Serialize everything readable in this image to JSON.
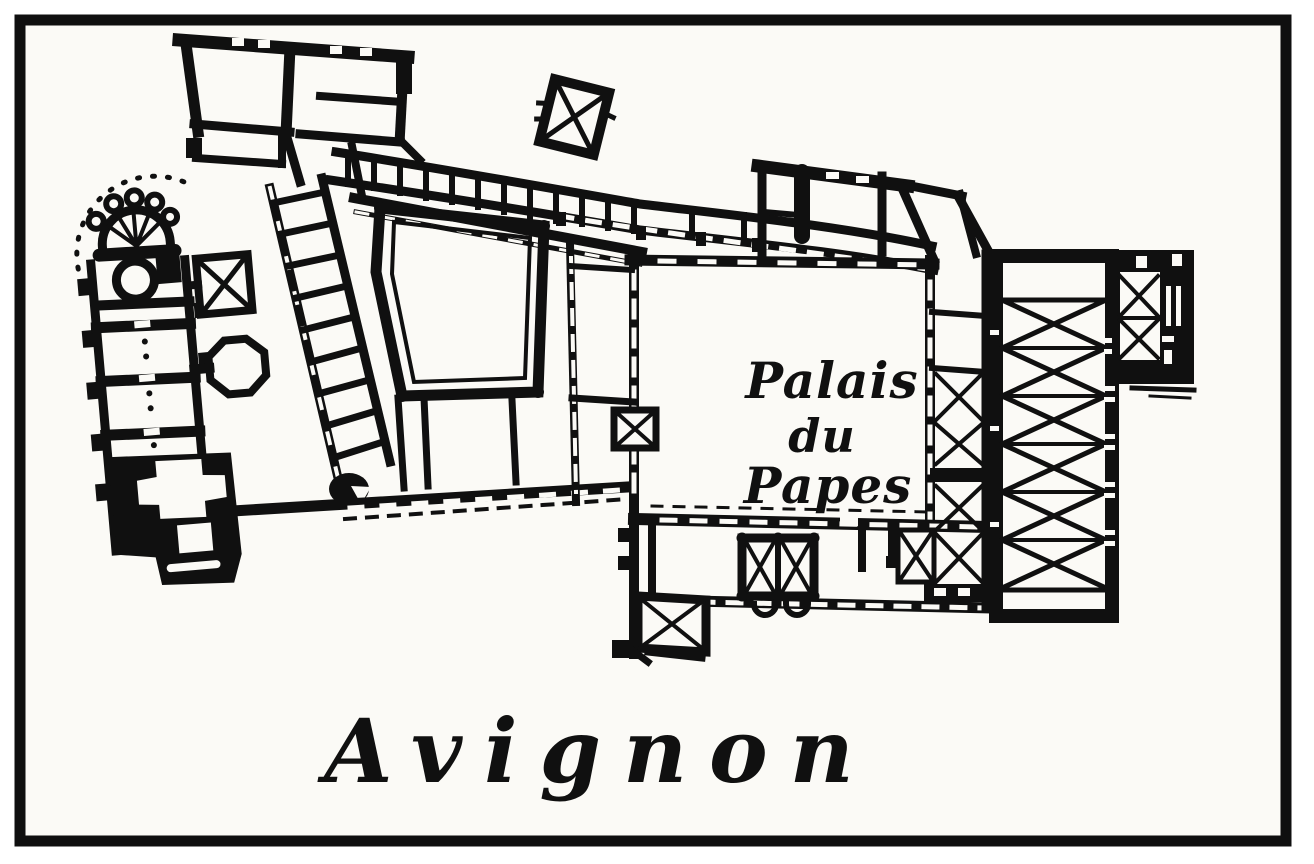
{
  "colors": {
    "ink": "#101010",
    "paper": "#ffffff",
    "panel": "#fbfaf6"
  },
  "plan_label": {
    "line1": "Palais",
    "line2": "du",
    "line3": "Papes"
  },
  "caption": "Avignon"
}
